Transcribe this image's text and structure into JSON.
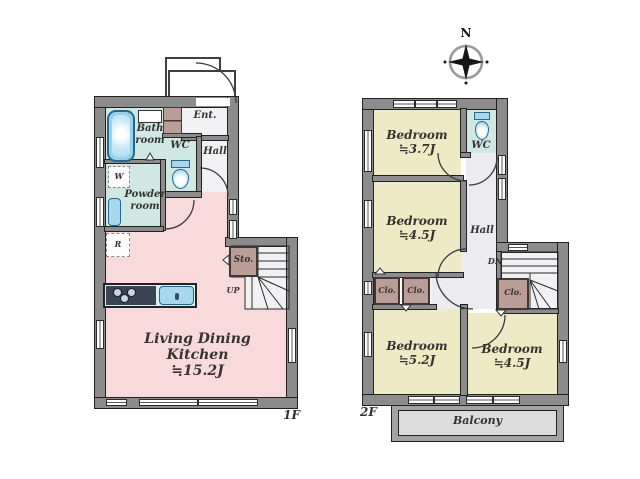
{
  "compass": {
    "north": "N"
  },
  "floor1": {
    "floor_label": "1F",
    "ldk_line1": "Living Dining",
    "ldk_line2": "Kitchen",
    "ldk_line3": "≒15.2J",
    "bath_line1": "Bath",
    "bath_line2": "room",
    "powder_line1": "Powder",
    "powder_line2": "room",
    "wc": "WC",
    "ent": "Ent.",
    "hall": "Hall",
    "sto": "Sto.",
    "washer": "W",
    "fridge": "R",
    "up": "UP"
  },
  "floor2": {
    "floor_label": "2F",
    "bedroom1_line1": "Bedroom",
    "bedroom1_line2": "≒3.7J",
    "bedroom2_line1": "Bedroom",
    "bedroom2_line2": "≒4.5J",
    "bedroom3_line1": "Bedroom",
    "bedroom3_line2": "≒5.2J",
    "bedroom4_line1": "Bedroom",
    "bedroom4_line2": "≒4.5J",
    "wc": "WC",
    "hall": "Hall",
    "closet1": "Clo.",
    "closet2": "Clo.",
    "closet3": "Clo.",
    "dn": "DN",
    "balcony": "Balcony"
  },
  "colors": {
    "wall": "#8c8c8c",
    "ldk_pink": "#f9dada",
    "wet_cyan": "#cfe8e3",
    "bedroom_yellow": "#eeeac6",
    "hall_gray": "#ebebf0",
    "closet_brown": "#bb9d98",
    "balcony_floor": "#dcdcdc",
    "fixture_blue": "#97d2ec"
  }
}
